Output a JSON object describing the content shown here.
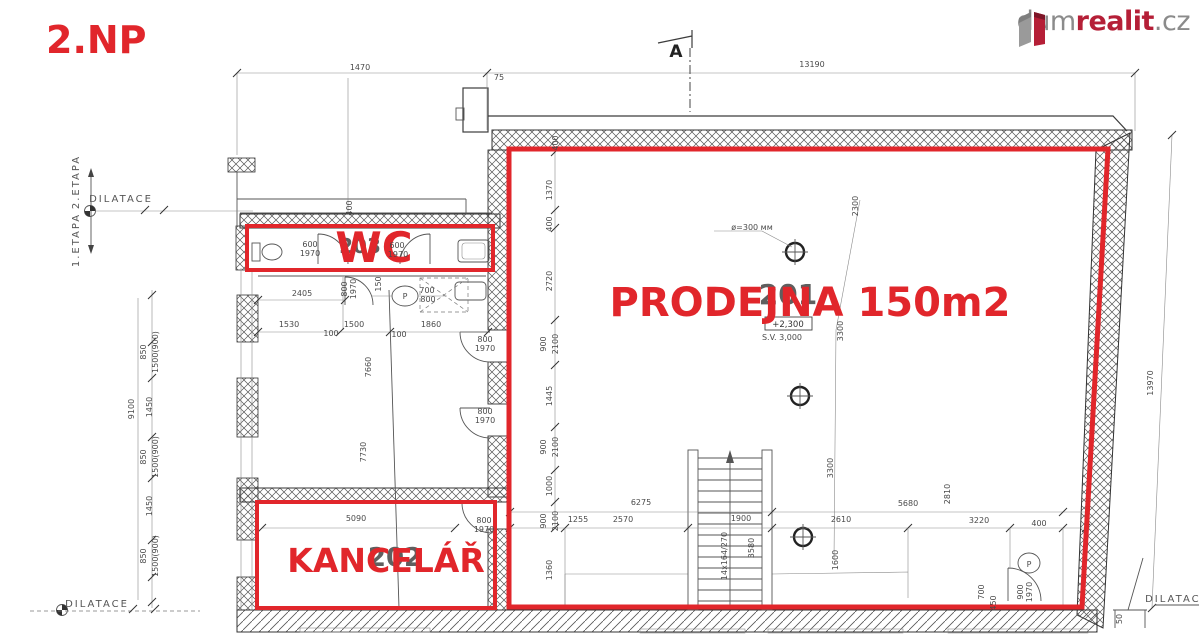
{
  "header": {
    "floor_label": "2.NP"
  },
  "logo": {
    "part_dum": "dum",
    "part_realit": "realit",
    "part_cz": ".cz"
  },
  "rooms": {
    "wc": {
      "label": "WC",
      "number": "203"
    },
    "prodejna": {
      "label": "PRODEJNA 150m2",
      "number": "201"
    },
    "kancelar": {
      "label": "KANCELÁŘ",
      "number": "202"
    }
  },
  "markers": {
    "section": "A",
    "dilatace_left": "DILATACE",
    "dilatace_bottom": "DILATACE",
    "dilatace_right": "DILATACE",
    "etapa_upper": "2.ETAPA",
    "etapa_lower": "1.ETAPA",
    "level": "+2,300",
    "ceiling_height": "S.V. 3,000",
    "column_note": "ø=300 мм"
  },
  "colors": {
    "annotation_red": "#e1262b",
    "logo_red": "#b51f37",
    "logo_gray": "#8b8b8b",
    "line_dark": "#3c3c3c",
    "dim_text": "#4a4a4a"
  },
  "dimension_labels": [
    {
      "t": "1470",
      "x": 360,
      "y": 70
    },
    {
      "t": "75",
      "x": 499,
      "y": 80
    },
    {
      "t": "13190",
      "x": 812,
      "y": 67
    },
    {
      "t": "400",
      "x": 558,
      "y": 143,
      "r": -90
    },
    {
      "t": "1370",
      "x": 552,
      "y": 190,
      "r": -90
    },
    {
      "t": "400",
      "x": 552,
      "y": 224,
      "r": -90
    },
    {
      "t": "2720",
      "x": 552,
      "y": 281,
      "r": -90
    },
    {
      "t": "900",
      "x": 546,
      "y": 344,
      "r": -90
    },
    {
      "t": "2100",
      "x": 558,
      "y": 344,
      "r": -90
    },
    {
      "t": "1445",
      "x": 552,
      "y": 396,
      "r": -90
    },
    {
      "t": "900",
      "x": 546,
      "y": 447,
      "r": -90
    },
    {
      "t": "2100",
      "x": 558,
      "y": 447,
      "r": -90
    },
    {
      "t": "1000",
      "x": 552,
      "y": 486,
      "r": -90
    },
    {
      "t": "900",
      "x": 546,
      "y": 521,
      "r": -90
    },
    {
      "t": "2100",
      "x": 558,
      "y": 521,
      "r": -90
    },
    {
      "t": "1360",
      "x": 552,
      "y": 570,
      "r": -90
    },
    {
      "t": "9100",
      "x": 134,
      "y": 409,
      "r": -90
    },
    {
      "t": "850",
      "x": 146,
      "y": 352,
      "r": -90
    },
    {
      "t": "1500(900)",
      "x": 158,
      "y": 352,
      "r": -90
    },
    {
      "t": "1450",
      "x": 152,
      "y": 407,
      "r": -90
    },
    {
      "t": "850",
      "x": 146,
      "y": 457,
      "r": -90
    },
    {
      "t": "1500(900)",
      "x": 158,
      "y": 457,
      "r": -90
    },
    {
      "t": "1450",
      "x": 152,
      "y": 506,
      "r": -90
    },
    {
      "t": "850",
      "x": 146,
      "y": 556,
      "r": -90
    },
    {
      "t": "1500(900)",
      "x": 158,
      "y": 556,
      "r": -90
    },
    {
      "t": "400",
      "x": 352,
      "y": 208,
      "r": -90
    },
    {
      "t": "2405",
      "x": 302,
      "y": 296
    },
    {
      "t": "800",
      "x": 347,
      "y": 289,
      "r": -90
    },
    {
      "t": "1970",
      "x": 356,
      "y": 289,
      "r": -90
    },
    {
      "t": "150",
      "x": 381,
      "y": 284,
      "r": -90
    },
    {
      "t": "700",
      "x": 427,
      "y": 293
    },
    {
      "t": "800",
      "x": 428,
      "y": 302
    },
    {
      "t": "1530",
      "x": 289,
      "y": 327
    },
    {
      "t": "1500",
      "x": 354,
      "y": 327
    },
    {
      "t": "1860",
      "x": 431,
      "y": 327
    },
    {
      "t": "100",
      "x": 331,
      "y": 336
    },
    {
      "t": "100",
      "x": 399,
      "y": 337
    },
    {
      "t": "7660",
      "x": 371,
      "y": 367,
      "r": -90
    },
    {
      "t": "7730",
      "x": 366,
      "y": 452,
      "r": -90
    },
    {
      "t": "600",
      "x": 310,
      "y": 247
    },
    {
      "t": "1970",
      "x": 310,
      "y": 256
    },
    {
      "t": "600",
      "x": 397,
      "y": 248
    },
    {
      "t": "1970",
      "x": 398,
      "y": 257
    },
    {
      "t": "800",
      "x": 485,
      "y": 342
    },
    {
      "t": "1970",
      "x": 485,
      "y": 351
    },
    {
      "t": "800",
      "x": 485,
      "y": 414
    },
    {
      "t": "1970",
      "x": 485,
      "y": 423
    },
    {
      "t": "800",
      "x": 484,
      "y": 523
    },
    {
      "t": "1970",
      "x": 484,
      "y": 532
    },
    {
      "t": "5090",
      "x": 356,
      "y": 521
    },
    {
      "t": "S.V. 3,000",
      "x": 782,
      "y": 340
    },
    {
      "t": "2300",
      "x": 858,
      "y": 206,
      "r": -90
    },
    {
      "t": "3300",
      "x": 843,
      "y": 331,
      "r": -90
    },
    {
      "t": "3300",
      "x": 833,
      "y": 468,
      "r": -90
    },
    {
      "t": "1600",
      "x": 838,
      "y": 560,
      "r": -90
    },
    {
      "t": "1900",
      "x": 741,
      "y": 521
    },
    {
      "t": "3580",
      "x": 754,
      "y": 548,
      "r": -90
    },
    {
      "t": "14x164/270",
      "x": 727,
      "y": 556,
      "r": -90
    },
    {
      "t": "6275",
      "x": 641,
      "y": 505
    },
    {
      "t": "5680",
      "x": 908,
      "y": 506
    },
    {
      "t": "2810",
      "x": 950,
      "y": 494,
      "r": -90
    },
    {
      "t": "1255",
      "x": 578,
      "y": 522
    },
    {
      "t": "2570",
      "x": 623,
      "y": 522
    },
    {
      "t": "2610",
      "x": 841,
      "y": 522
    },
    {
      "t": "3220",
      "x": 979,
      "y": 523
    },
    {
      "t": "400",
      "x": 1039,
      "y": 526
    },
    {
      "t": "700",
      "x": 984,
      "y": 592,
      "r": -90
    },
    {
      "t": "450",
      "x": 996,
      "y": 603,
      "r": -90
    },
    {
      "t": "900",
      "x": 1023,
      "y": 592,
      "r": -90
    },
    {
      "t": "1970",
      "x": 1032,
      "y": 592,
      "r": -90
    },
    {
      "t": "50",
      "x": 1122,
      "y": 619,
      "r": -90
    },
    {
      "t": "13970",
      "x": 1153,
      "y": 383,
      "r": -90
    },
    {
      "t": "P",
      "x": 405,
      "y": 299
    },
    {
      "t": "P",
      "x": 1029,
      "y": 567
    }
  ]
}
